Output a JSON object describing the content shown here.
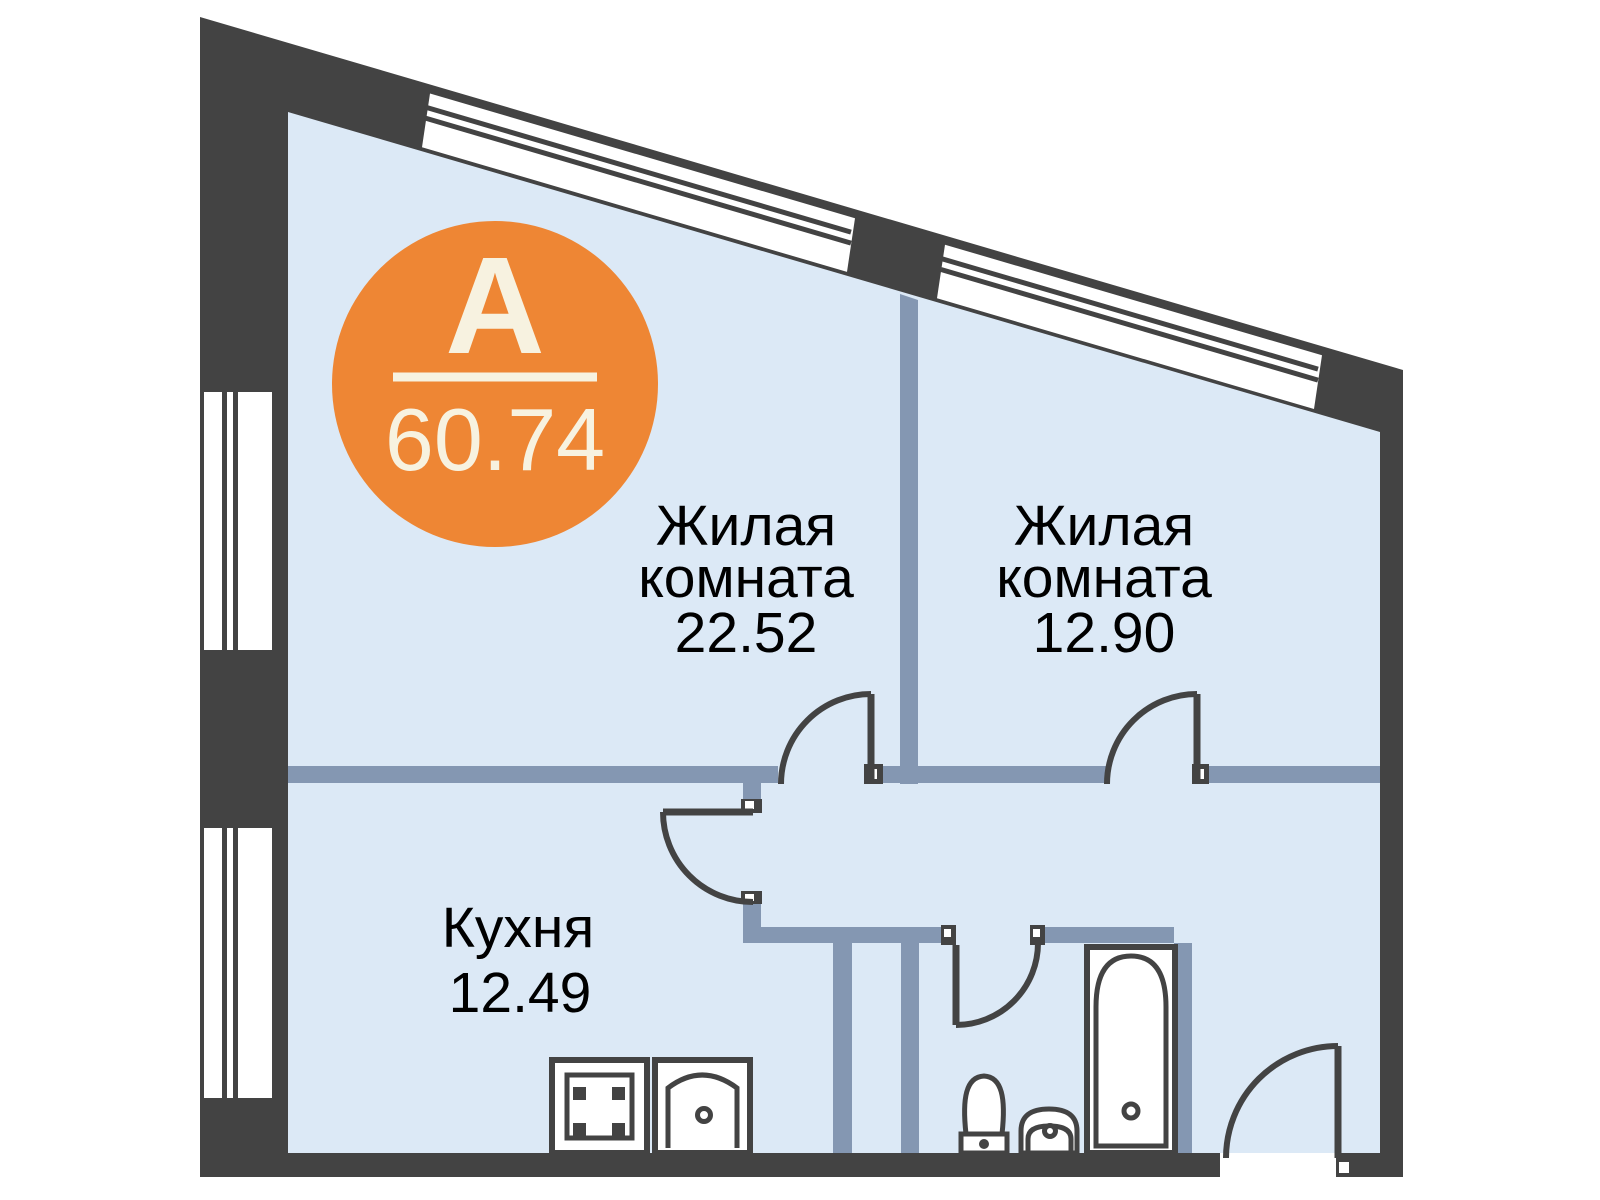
{
  "badge": {
    "letter": "A",
    "total_area": "60.74"
  },
  "rooms": [
    {
      "id": "living-room-1",
      "name_line1": "Жилая",
      "name_line2": "комната",
      "area": "22.52"
    },
    {
      "id": "living-room-2",
      "name_line1": "Жилая",
      "name_line2": "комната",
      "area": "12.90"
    },
    {
      "id": "kitchen",
      "name": "Кухня",
      "area": "12.49"
    }
  ],
  "icons": {
    "stove": "stove-icon",
    "kitchen_sink": "kitchen-sink-icon",
    "toilet": "toilet-icon",
    "washbasin": "washbasin-icon",
    "bathtub": "bathtub-icon"
  },
  "colors": {
    "accent_orange": "#EE8634",
    "wall_dark": "#434343",
    "partition_blue": "#8497B2",
    "floor_light_blue": "#DCE9F6",
    "badge_text": "#F7F2E0",
    "label_text": "#000000",
    "background": "#FFFFFF"
  }
}
